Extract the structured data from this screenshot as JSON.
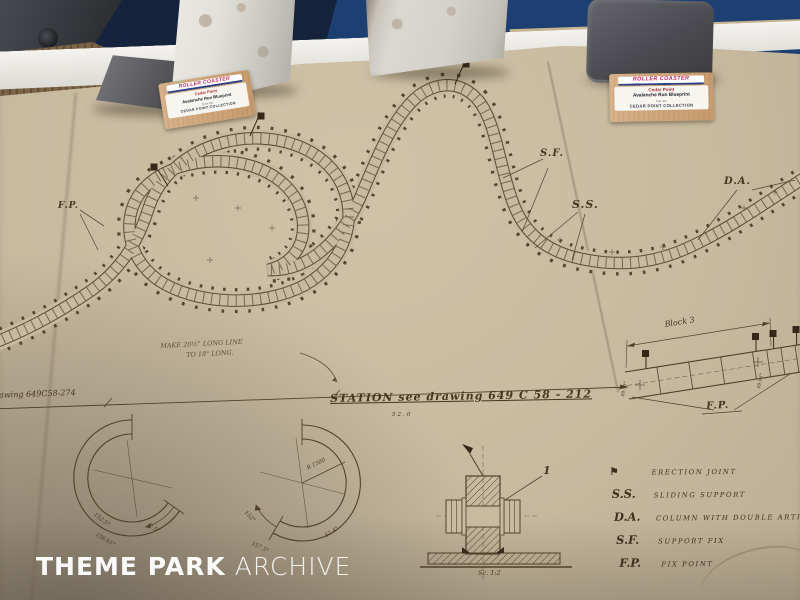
{
  "watermark": {
    "bold": "THEME PARK",
    "light": "ARCHIVE"
  },
  "cards": {
    "logo_text": "ROLLER COASTER",
    "park": "Cedar Point",
    "item": "Avalanche Run Blueprint",
    "sub": "from the",
    "collection": "CEDAR POINT COLLECTION"
  },
  "drawing": {
    "label_fp": "F.P.",
    "label_sf": "S.F.",
    "label_ss": "S.S.",
    "label_da": "D.A.",
    "station_title": "STATION  see drawing 649 C 58 - 212",
    "station_sub": "52.0",
    "left_ref": "drawing 649C58-274",
    "note_line1": "MAKE 20½\" LONG LINE",
    "note_line2": "TO 18\" LONG.",
    "block_title": "Block 3",
    "block_fp": "F.P.",
    "block_angle_left": "89.50°",
    "block_angle_right": "89.96°",
    "callout_1": "1",
    "scale_note": "Sc. 1:2",
    "arc_left": {
      "a1": "152.5°",
      "a2": "156.61°",
      "a3": "7.5°"
    },
    "arc_right": {
      "radius": "R 1500",
      "a1": "152°",
      "a2": "157.5°",
      "a3": "52.4°"
    },
    "legend": {
      "flag_icon": "⚑",
      "rows": [
        {
          "key": "",
          "desc": "ERECTION JOINT"
        },
        {
          "key": "S.S.",
          "desc": "SLIDING SUPPORT"
        },
        {
          "key": "D.A.",
          "desc": "COLUMN WITH DOUBLE ARTICULATION"
        },
        {
          "key": "S.F.",
          "desc": "SUPPORT FIX"
        },
        {
          "key": "F.P.",
          "desc": "FIX POINT"
        }
      ]
    }
  },
  "colors": {
    "paper": "#c8ba9f",
    "ink": "#50402b",
    "table_blue": "#1d3f72",
    "card_red": "#c2275f"
  }
}
